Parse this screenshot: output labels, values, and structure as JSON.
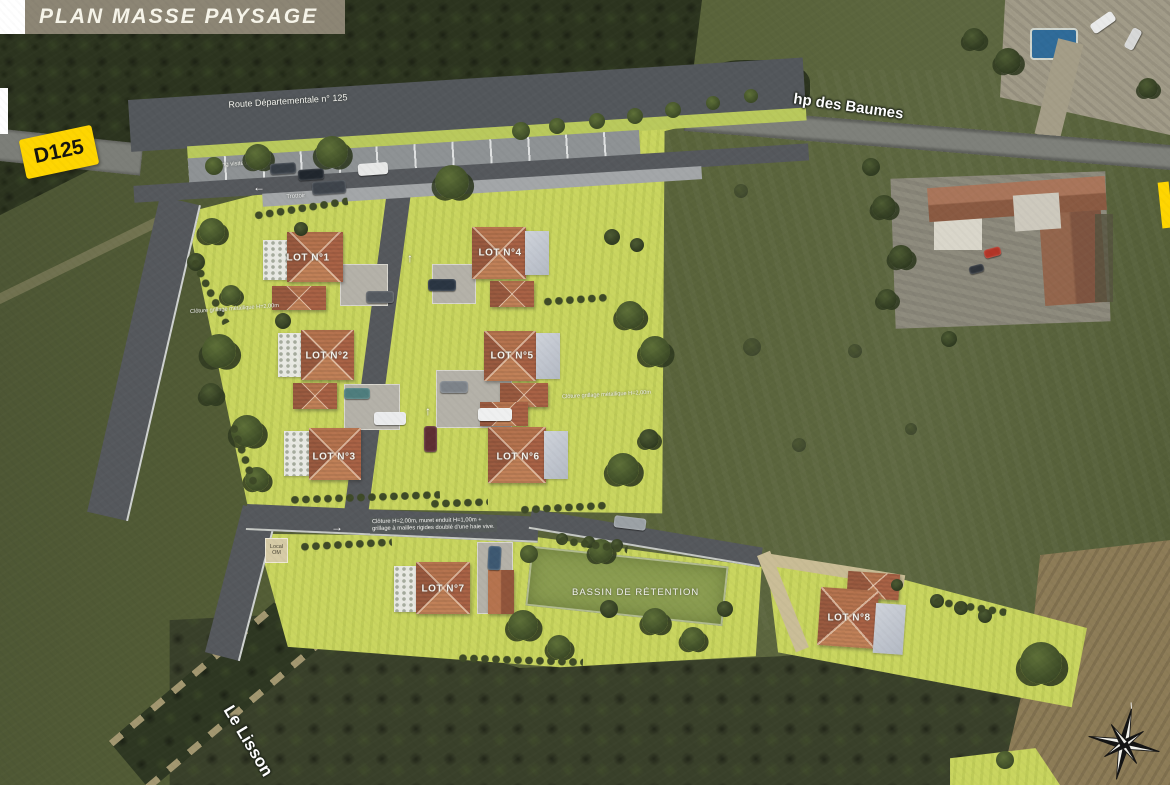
{
  "title": "PLAN MASSE PAYSAGE",
  "signs": {
    "d125": "D125"
  },
  "road_labels": {
    "rd125": "Route Départementale n° 125",
    "parking": "Parking visiteur",
    "trottoir": "Trottoir",
    "street": "hp des Baumes",
    "river": "Le Lisson"
  },
  "annotations": {
    "fence_left": "Clôture grillage métallique H=2,00m",
    "fence_right": "Clôture grillage métallique H=2,00m",
    "fence_main_line1": "Clôture H=2,00m, muret enduit H=1,00m +",
    "fence_main_line2": "grillage à mailles rigides doublé d'une haie vive.",
    "local_om": "Local OM",
    "bassin": "BASSIN DE RÉTENTION"
  },
  "lots": [
    {
      "label": "LOT N°1",
      "x": 308,
      "y": 258
    },
    {
      "label": "LOT N°2",
      "x": 327,
      "y": 356
    },
    {
      "label": "LOT N°3",
      "x": 334,
      "y": 457
    },
    {
      "label": "LOT N°4",
      "x": 500,
      "y": 253
    },
    {
      "label": "LOT N°5",
      "x": 512,
      "y": 356
    },
    {
      "label": "LOT N°6",
      "x": 518,
      "y": 457
    },
    {
      "label": "LOT N°7",
      "x": 443,
      "y": 589
    },
    {
      "label": "LOT N°8",
      "x": 849,
      "y": 618
    }
  ],
  "arrows": [
    {
      "dir": "left",
      "x": 253,
      "y": 180
    },
    {
      "dir": "up",
      "x": 407,
      "y": 251
    },
    {
      "dir": "up",
      "x": 425,
      "y": 404
    },
    {
      "dir": "right",
      "x": 331,
      "y": 520
    }
  ],
  "trees": [
    [
      214,
      166,
      9,
      "m"
    ],
    [
      258,
      157,
      13,
      "m"
    ],
    [
      332,
      152,
      16,
      "m"
    ],
    [
      452,
      182,
      17,
      "m"
    ],
    [
      521,
      131,
      9,
      "m"
    ],
    [
      557,
      126,
      8,
      "m"
    ],
    [
      597,
      121,
      8,
      "m"
    ],
    [
      635,
      116,
      8,
      "m"
    ],
    [
      673,
      110,
      8,
      "m"
    ],
    [
      713,
      103,
      7,
      "m"
    ],
    [
      751,
      96,
      7,
      "m"
    ],
    [
      212,
      231,
      13,
      "m"
    ],
    [
      196,
      262,
      9,
      "d"
    ],
    [
      231,
      295,
      10,
      "m"
    ],
    [
      219,
      351,
      17,
      "m"
    ],
    [
      247,
      431,
      16,
      "m"
    ],
    [
      211,
      394,
      11,
      "d"
    ],
    [
      257,
      479,
      12,
      "m"
    ],
    [
      283,
      321,
      8,
      "d"
    ],
    [
      301,
      229,
      7,
      "d"
    ],
    [
      612,
      237,
      8,
      "d"
    ],
    [
      637,
      245,
      7,
      "d"
    ],
    [
      630,
      315,
      14,
      "m"
    ],
    [
      655,
      351,
      15,
      "m"
    ],
    [
      623,
      469,
      16,
      "m"
    ],
    [
      649,
      439,
      10,
      "d"
    ],
    [
      529,
      554,
      9,
      "m"
    ],
    [
      601,
      551,
      12,
      "m"
    ],
    [
      523,
      625,
      15,
      "m"
    ],
    [
      559,
      647,
      12,
      "m"
    ],
    [
      655,
      621,
      13,
      "m"
    ],
    [
      693,
      639,
      12,
      "m"
    ],
    [
      609,
      609,
      9,
      "d"
    ],
    [
      725,
      609,
      8,
      "d"
    ],
    [
      562,
      539,
      6,
      "d"
    ],
    [
      589,
      542,
      6,
      "d"
    ],
    [
      617,
      545,
      6,
      "d"
    ],
    [
      937,
      601,
      7,
      "d"
    ],
    [
      961,
      608,
      7,
      "d"
    ],
    [
      985,
      616,
      7,
      "d"
    ],
    [
      1041,
      663,
      21,
      "m"
    ],
    [
      897,
      585,
      6,
      "d"
    ],
    [
      752,
      347,
      9,
      "f"
    ],
    [
      799,
      445,
      7,
      "f"
    ],
    [
      855,
      351,
      7,
      "f"
    ],
    [
      741,
      191,
      7,
      "f"
    ],
    [
      911,
      429,
      6,
      "f"
    ],
    [
      884,
      207,
      12,
      "d"
    ],
    [
      901,
      257,
      12,
      "d"
    ],
    [
      887,
      299,
      10,
      "d"
    ],
    [
      871,
      167,
      9,
      "d"
    ],
    [
      949,
      339,
      8,
      "d"
    ],
    [
      1008,
      61,
      13,
      "d"
    ],
    [
      974,
      39,
      11,
      "d"
    ],
    [
      1148,
      88,
      10,
      "d"
    ],
    [
      1005,
      760,
      9,
      "m"
    ]
  ],
  "shrub_rows": [
    [
      254,
      212,
      95,
      -9
    ],
    [
      290,
      496,
      150,
      -2
    ],
    [
      543,
      298,
      66,
      -4
    ],
    [
      520,
      506,
      88,
      -3
    ],
    [
      430,
      500,
      58,
      -2
    ],
    [
      300,
      543,
      92,
      -3
    ],
    [
      558,
      536,
      70,
      8
    ],
    [
      933,
      597,
      74,
      9
    ],
    [
      458,
      654,
      125,
      2
    ],
    [
      193,
      255,
      72,
      63
    ],
    [
      232,
      420,
      64,
      70
    ]
  ],
  "cars": [
    [
      270,
      163,
      26,
      11,
      -4,
      "#363d45"
    ],
    [
      298,
      169,
      26,
      11,
      -4,
      "#20262d"
    ],
    [
      312,
      181,
      34,
      13,
      -4,
      "#3e444b"
    ],
    [
      358,
      163,
      30,
      12,
      -4,
      "#e7e8e7"
    ],
    [
      428,
      279,
      28,
      12,
      0,
      "#2a3542"
    ],
    [
      366,
      291,
      28,
      12,
      0,
      "#555a60"
    ],
    [
      344,
      388,
      26,
      11,
      0,
      "#4e7d7d"
    ],
    [
      374,
      412,
      32,
      13,
      0,
      "#ebeced"
    ],
    [
      440,
      381,
      28,
      12,
      0,
      "#7d8389"
    ],
    [
      478,
      408,
      34,
      13,
      0,
      "#eff0f0"
    ],
    [
      424,
      426,
      13,
      26,
      0,
      "#5d2e33"
    ],
    [
      614,
      517,
      32,
      12,
      7,
      "#9ba1a5"
    ],
    [
      488,
      546,
      13,
      24,
      3,
      "#3d5871"
    ],
    [
      984,
      248,
      17,
      9,
      -15,
      "#b23527"
    ],
    [
      969,
      265,
      15,
      8,
      -15,
      "#2f343a"
    ],
    [
      1090,
      17,
      26,
      11,
      -35,
      "#e9eaea"
    ],
    [
      1122,
      34,
      22,
      10,
      -62,
      "#d7d8d8"
    ]
  ],
  "colors": {
    "accent_yellow": "#fed501",
    "lawn_green": "#c9d55f",
    "basin_green": "#8a9c50",
    "road_gray": "#55585c",
    "roof_terracotta": "#b5734e",
    "banner_olive": "#8c8574"
  }
}
